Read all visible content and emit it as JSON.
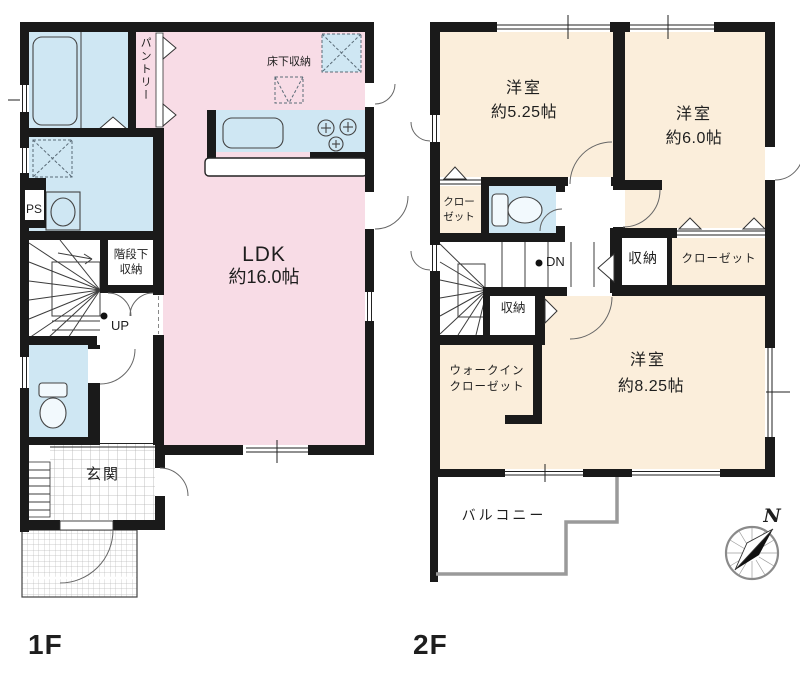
{
  "colors": {
    "room_pink": "#f8dce6",
    "room_cream": "#fbeedb",
    "water_blue": "#cfe7f3",
    "wall_black": "#1a1a1a"
  },
  "floor1": {
    "label": "1F",
    "ldk_line1": "LDK",
    "ldk_line2": "約16.0帖",
    "pantry": "パントリー",
    "underfloor_storage": "床下収納",
    "under_stairs_storage_line1": "階段下",
    "under_stairs_storage_line2": "収納",
    "stairs_up": "UP",
    "pipe_space": "PS",
    "entrance": "玄関"
  },
  "floor2": {
    "label": "2F",
    "bedroom1_line1": "洋室",
    "bedroom1_line2": "約5.25帖",
    "bedroom2_line1": "洋室",
    "bedroom2_line2": "約6.0帖",
    "bedroom3_line1": "洋室",
    "bedroom3_line2": "約8.25帖",
    "closet_small_line1": "クロー",
    "closet_small_line2": "ゼット",
    "stairs_down": "DN",
    "storage_hall": "収納",
    "closet_bedroom2": "クローゼット",
    "storage_lower": "収納",
    "walkin_closet_line1": "ウォークイン",
    "walkin_closet_line2": "クローゼット",
    "balcony": "バルコニー"
  },
  "compass": {
    "north": "N"
  }
}
